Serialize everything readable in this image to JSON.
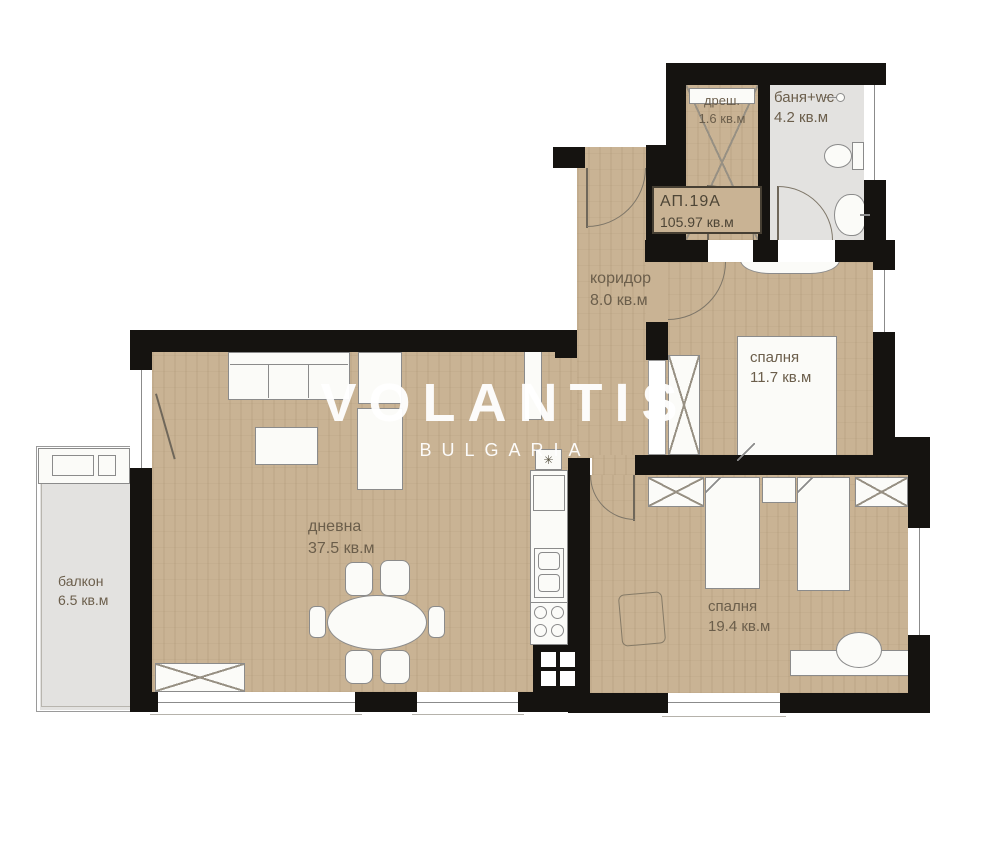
{
  "watermark": {
    "brand": "VOLANTIS",
    "sub": "BULGARIA"
  },
  "apartment": {
    "id": "АП.19А",
    "area": "105.97 кв.м"
  },
  "rooms": {
    "closet": {
      "name": "дреш.",
      "area": "1.6 кв.м"
    },
    "bath": {
      "name": "баня+wc",
      "area": "4.2 кв.м"
    },
    "corridor": {
      "name": "коридор",
      "area": "8.0 кв.м"
    },
    "bedroom1": {
      "name": "спалня",
      "area": "11.7 кв.м"
    },
    "living": {
      "name": "дневна",
      "area": "37.5 кв.м"
    },
    "bedroom2": {
      "name": "спалня",
      "area": "19.4 кв.м"
    },
    "balcony": {
      "name": "балкон",
      "area": "6.5 кв.м"
    }
  },
  "icons": {
    "boiler": "✳"
  },
  "colors": {
    "floor": "#c9b394",
    "wet": "#e3e2e0",
    "wall": "#151310",
    "label": "#6b5e4b"
  }
}
